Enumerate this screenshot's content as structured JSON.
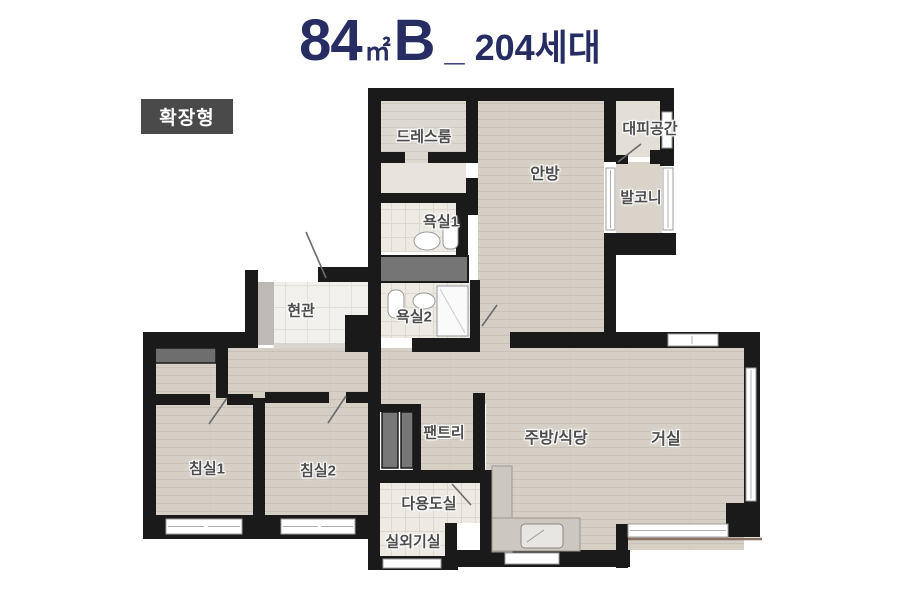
{
  "title": {
    "area": "84",
    "unit": "㎡",
    "type": "B",
    "separator": "_",
    "households": "204세대"
  },
  "badge": {
    "label": "확장형"
  },
  "floorplan": {
    "rooms": [
      {
        "id": "dressroom",
        "label": "드레스룸"
      },
      {
        "id": "shelter",
        "label": "대피공간"
      },
      {
        "id": "master-bedroom",
        "label": "안방"
      },
      {
        "id": "balcony",
        "label": "발코니"
      },
      {
        "id": "bathroom1",
        "label": "욕실1"
      },
      {
        "id": "entrance",
        "label": "현관"
      },
      {
        "id": "bathroom2",
        "label": "욕실2"
      },
      {
        "id": "pantry",
        "label": "팬트리"
      },
      {
        "id": "kitchen-dining",
        "label": "주방/식당"
      },
      {
        "id": "living-room",
        "label": "거실"
      },
      {
        "id": "bedroom1",
        "label": "침실1"
      },
      {
        "id": "bedroom2",
        "label": "침실2"
      },
      {
        "id": "utility-room",
        "label": "다용도실"
      },
      {
        "id": "outdoor-unit-room",
        "label": "실외기실"
      }
    ],
    "colors": {
      "wall": "#1a1a1a",
      "wood_floor": "#d5cfc6",
      "tile_floor": "#edeae4",
      "entrance_tile": "#f2f0ec",
      "closet_gray": "#757575",
      "window_white": "#ffffff",
      "title_navy": "#272c63",
      "badge_bg": "#4a4a4a"
    }
  }
}
